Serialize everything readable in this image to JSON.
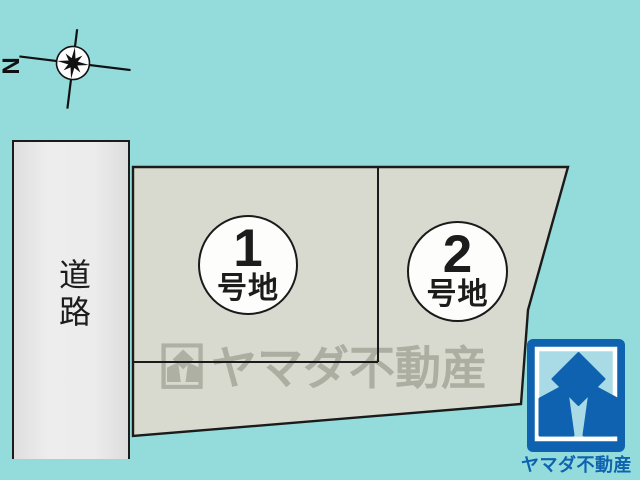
{
  "compass": {
    "north_label": "N"
  },
  "road": {
    "label": "道路"
  },
  "lots": [
    {
      "number": "1",
      "suffix": "号地"
    },
    {
      "number": "2",
      "suffix": "号地"
    }
  ],
  "watermark": {
    "text": "ヤマダ不動産"
  },
  "logo": {
    "brand": "ヤマダ不動産"
  },
  "colors": {
    "background": "#94dcdc",
    "parcel_fill": "#d8dacf",
    "road_fill": "#e9e9e9",
    "outline": "#1b1b1b",
    "brand_blue": "#0e62af",
    "logo_inner_blue": "#a8dbe5",
    "watermark_gray": "#6e7364"
  }
}
